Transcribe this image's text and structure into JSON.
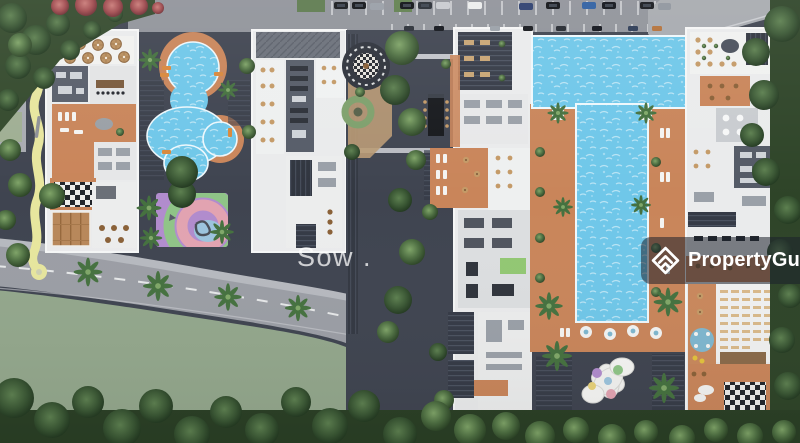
{
  "image": {
    "alt": "Aerial 3D rendering of a condominium development site plan with swimming pools, sun decks, playground, gardens, parking and surrounding roads"
  },
  "watermarks": {
    "site_label": "Sow .",
    "brand_name": "PropertyGuru"
  },
  "icons": {
    "brand_logo": "propertyguru-diamond-icon"
  },
  "colors": {
    "pool_blue": "#6fc7e9",
    "deck_orange": "#c9855a",
    "building_white": "#eaebec",
    "courtyard_dark": "#3f4450",
    "road_gray": "#9b9ea5",
    "sidewalk_gray": "#b6b9bf",
    "parking_gray": "#90939a",
    "lawn_green": "#93a78c",
    "tree_dark": "#2c4426",
    "path_yellow": "#e7e69e",
    "playground_purple": "#b18ccd",
    "wood_brown": "#b8875a",
    "badge_bg": "rgba(28,33,43,0.55)",
    "watermark_text": "rgba(255,255,255,0.75)",
    "brand_white": "#ffffff"
  }
}
